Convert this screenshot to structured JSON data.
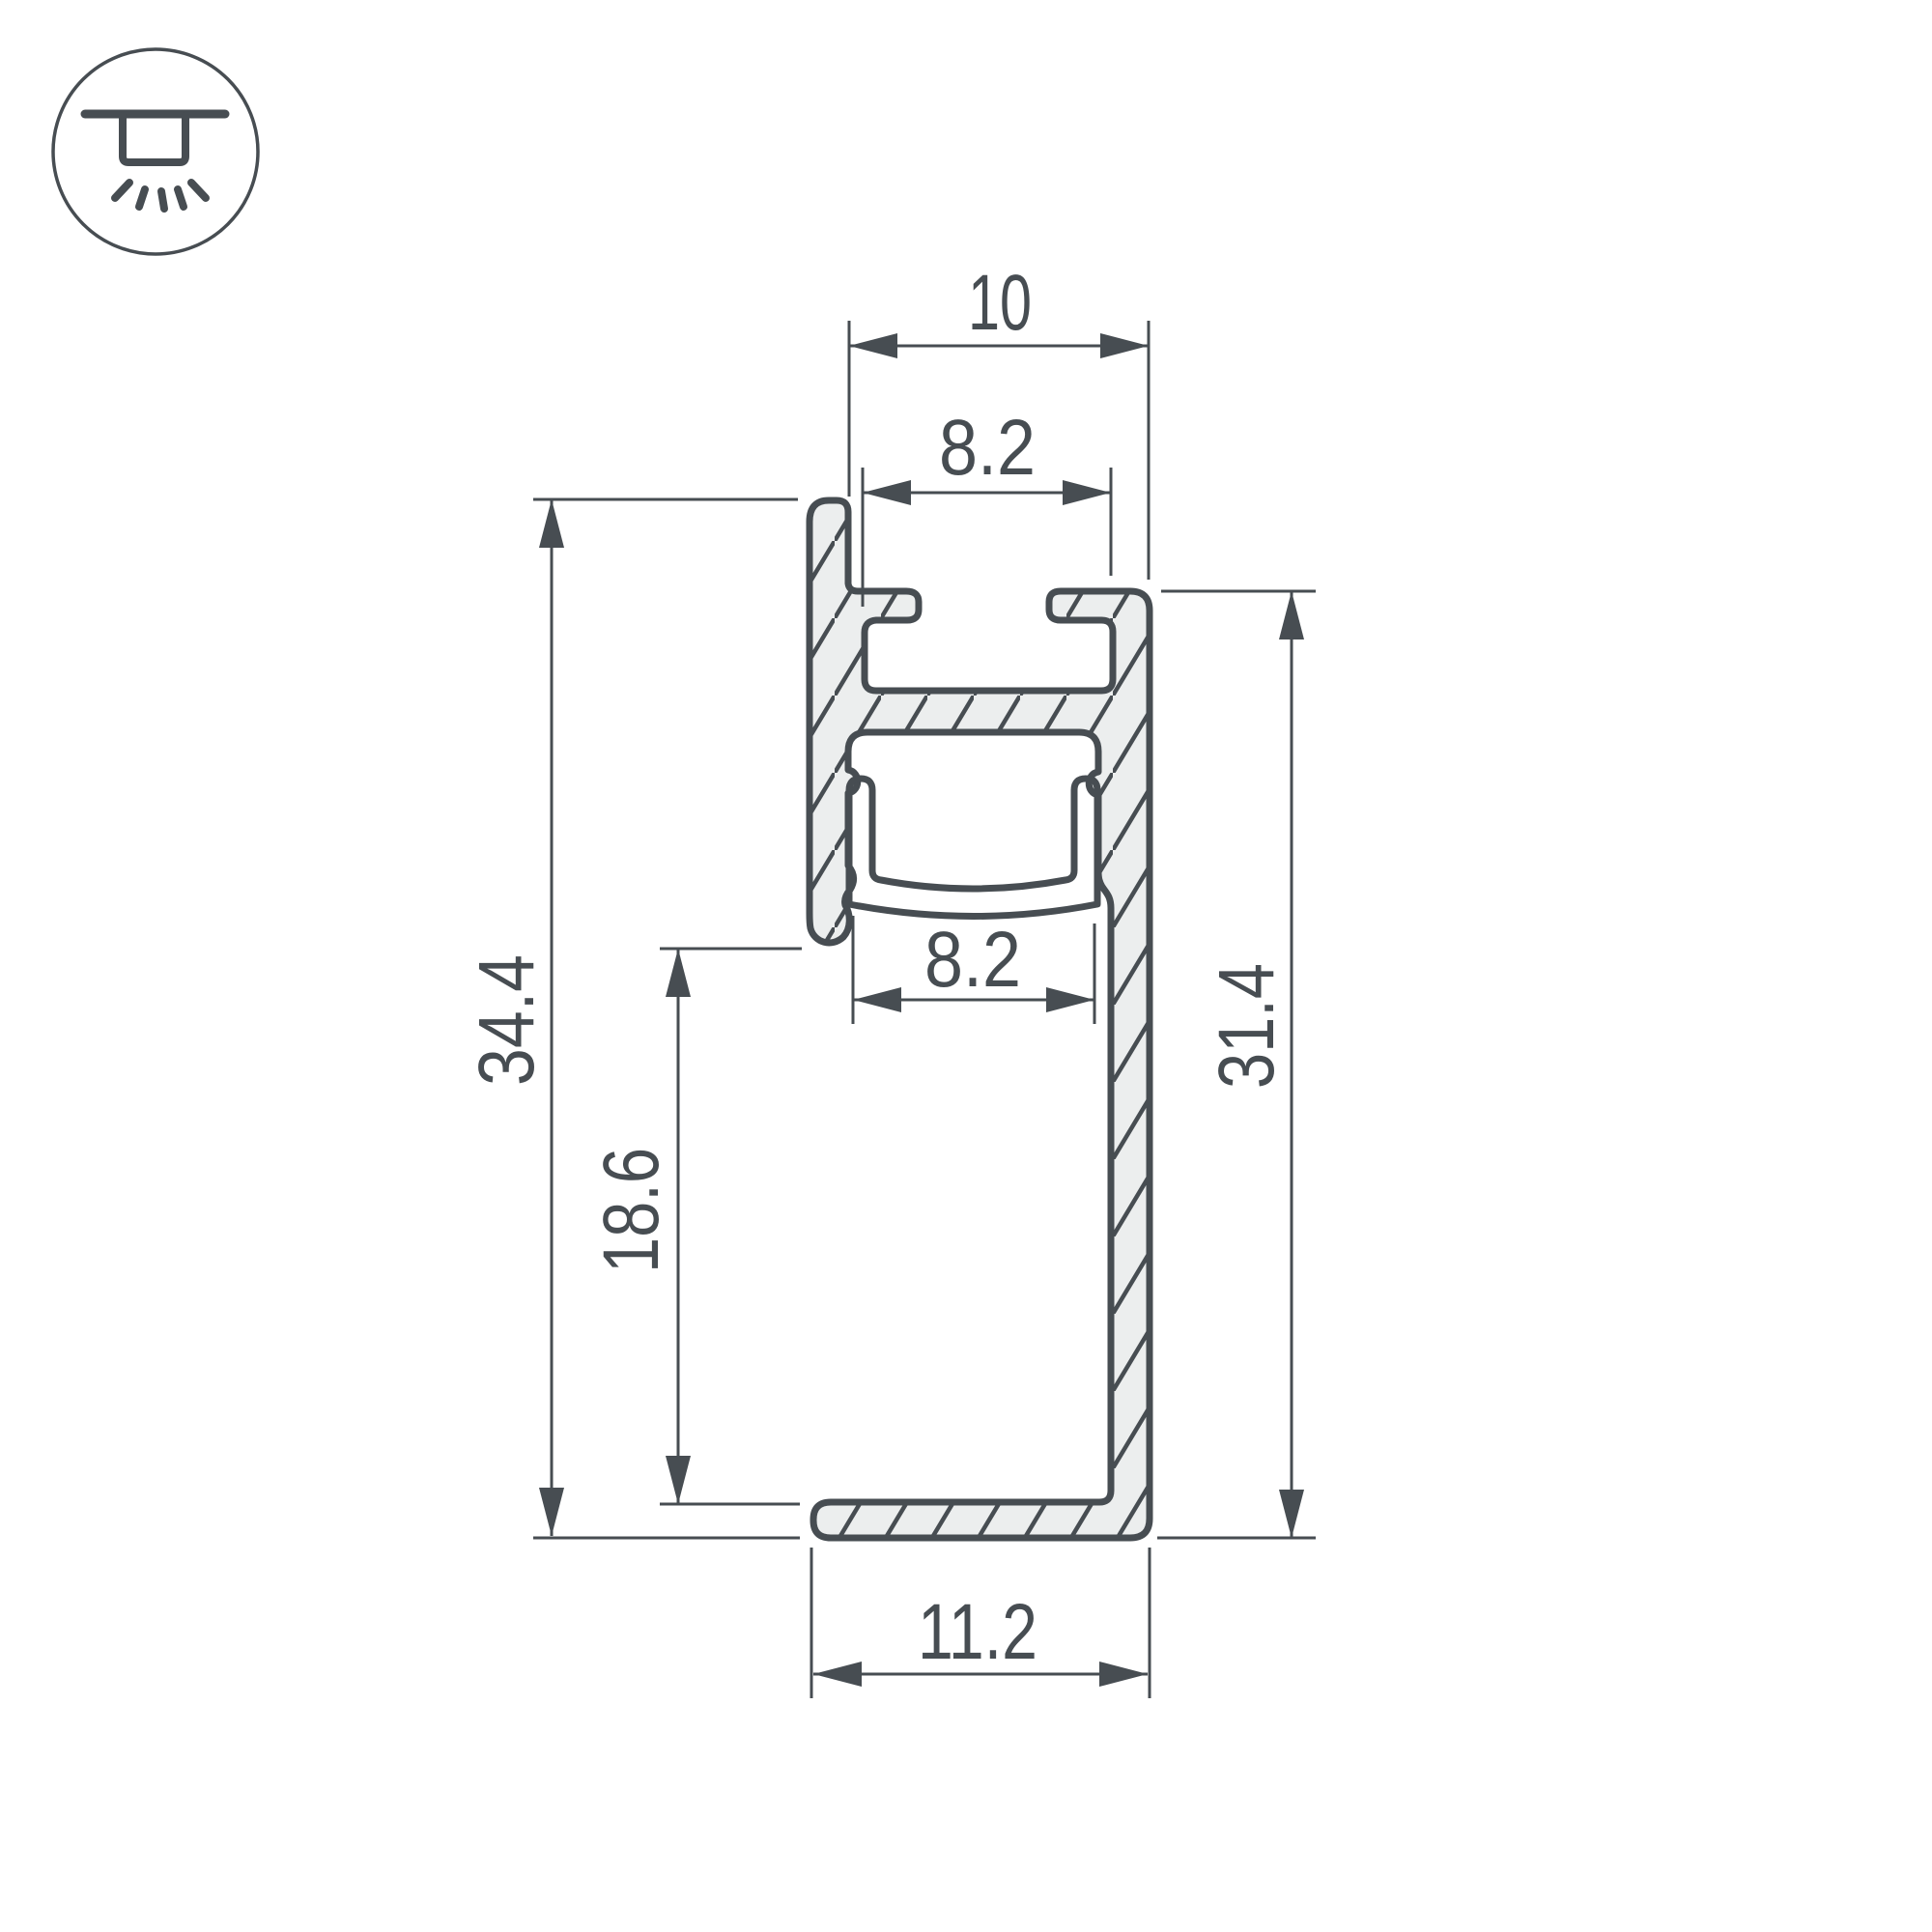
{
  "drawing": {
    "kind": "led-profile-cross-section",
    "dims": {
      "top_channel_outer_width": "10",
      "top_channel_inner_width": "8.2",
      "diffuser_opening_width": "8.2",
      "overall_height": "34.4",
      "underside_clearance_height": "18.6",
      "right_side_height": "31.4",
      "base_flange_width": "11.2"
    },
    "colors": {
      "ink": "#474d52",
      "metal_fill": "#eceeee",
      "background": "#ffffff"
    },
    "icon": {
      "name": "recessed-downlight-icon"
    }
  }
}
